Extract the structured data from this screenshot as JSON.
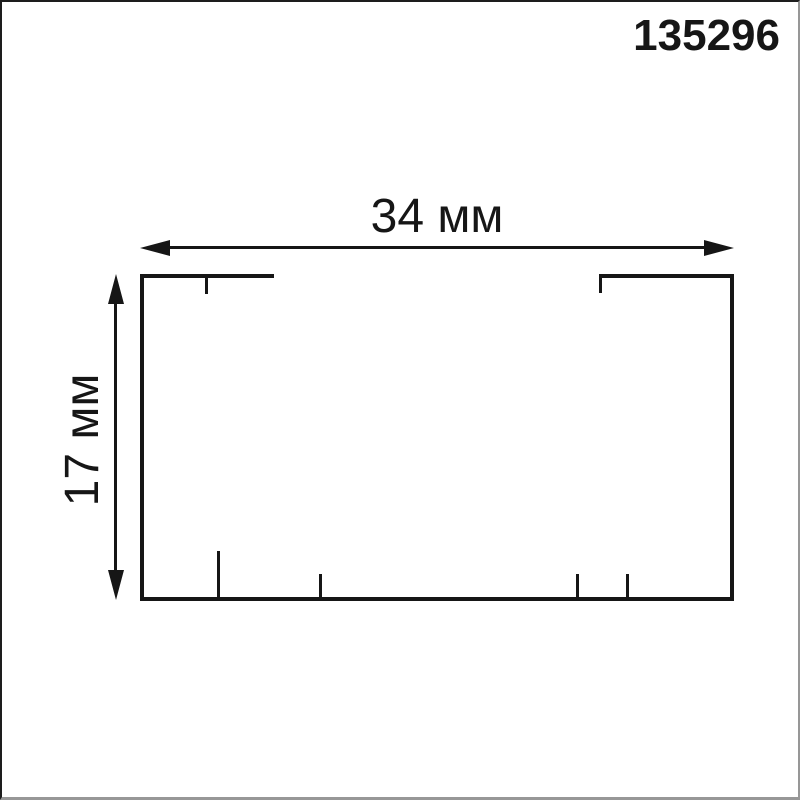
{
  "page": {
    "part_number": "135296",
    "background": "#ffffff",
    "ink_color": "#161616",
    "border_dark": "#1d1d1d",
    "border_light": "#979797"
  },
  "diagram": {
    "type": "technical-drawing",
    "shape": "rectangular profile cross-section with open slot in top edge and mounting ticks",
    "width_label": "34 мм",
    "height_label": "17 мм",
    "width_mm": 34,
    "height_mm": 17,
    "units": "мм"
  }
}
